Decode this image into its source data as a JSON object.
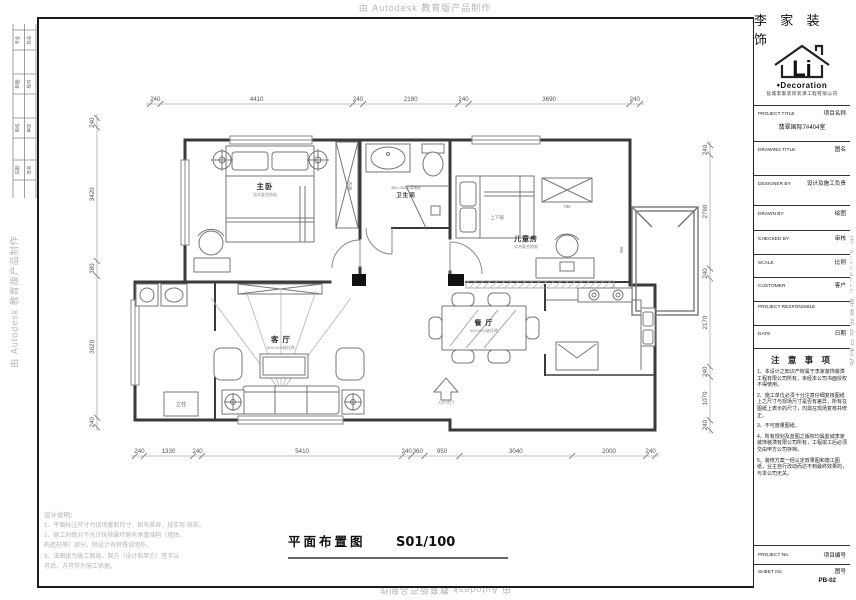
{
  "watermark": "由 Autodesk 教育版产品制作",
  "sheet_title": {
    "label": "平面布置图",
    "scale": "S01/100"
  },
  "design_notes": {
    "title": "设计说明：",
    "lines": [
      "1、平面标注尺寸为现场量取尺寸，如有差异，按实际 核实。",
      "2、施工时绝对不允许拆除破坏原有承重结构（墙体、",
      "构造柱等）部分，除设计有特殊说明外。",
      "3、该图纸为施工图纸，双方（设计和甲方）签字认",
      "可后，方可作为施工依据。"
    ]
  },
  "sign_strip": {
    "rows": [
      [
        "专业",
        "姓名"
      ],
      [
        "制图",
        "校对"
      ],
      [
        "审核",
        "审定"
      ],
      [
        "日期",
        "签名"
      ]
    ]
  },
  "title_block": {
    "brand": "李 家 装 饰",
    "logo_text": "Li",
    "logo_sub": "Decoration",
    "company": "盐城李家装饰装潢工程有限公司",
    "fields": [
      {
        "en": "PROJECT TITLE",
        "cn": "项目名称",
        "value": "翡翠国际7#404室"
      },
      {
        "en": "DRAWING TITLE",
        "cn": "图名",
        "value": ""
      },
      {
        "en": "DESIGNER BY",
        "cn": "设计及施工负责",
        "value": ""
      },
      {
        "en": "DRAWN BY",
        "cn": "绘图",
        "value": ""
      },
      {
        "en": "CHECKED BY",
        "cn": "审核",
        "value": ""
      },
      {
        "en": "SCALE",
        "cn": "比例",
        "value": ""
      },
      {
        "en": "CUSTOMER",
        "cn": "客户",
        "value": ""
      },
      {
        "en": "PROJECT RESPONSIBLE",
        "cn": "",
        "value": ""
      },
      {
        "en": "DATE",
        "cn": "日期",
        "value": ""
      }
    ],
    "notice": {
      "title": "注 意 事 项",
      "items": [
        "1、本设计之知识产权属于李家装饰装潢工程有限公司所有，未经本公司书面授权不得使用。",
        "2、施工单位必须十分注意仔细复核图纸上之尺寸与现场尺寸是否有差异，所有在图纸上表示的尺寸，均需在现场复核并修正。",
        "3、不可度量图纸。",
        "4、所有规划及蓝图之版权均属盐城李家装饰装潢有限公司所有，工程竣工后必须交由甲方公司存档。",
        "5、装修方案一经认定效果图和施工图纸，业主自行改动而达不到最终效果的，与本公司无关。"
      ]
    },
    "project_no": {
      "en": "PROJECT No.",
      "cn": "项目编号"
    },
    "sheet_no": {
      "en": "SHEET No.",
      "cn": "图号",
      "value": "PB-02"
    }
  },
  "plan": {
    "rooms": [
      {
        "name": "主卧",
        "sub": "实木复合地板",
        "x": 265,
        "y": 189,
        "size": 7.5
      },
      {
        "name": "卫生间",
        "sub": "",
        "x": 406,
        "y": 197,
        "size": 5.5
      },
      {
        "name": "儿童房",
        "sub": "实木复合地板",
        "x": 526,
        "y": 241,
        "size": 7
      },
      {
        "name": "客 厅",
        "sub": "800×800玻化砖",
        "x": 281,
        "y": 342,
        "size": 7.5
      },
      {
        "name": "餐 厅",
        "sub": "800×800玻化砖",
        "x": 484,
        "y": 325,
        "size": 7
      }
    ],
    "annotations": [
      {
        "text": "300×300防滑地砖",
        "x": 406,
        "y": 189,
        "size": 3.8
      },
      {
        "text": "上下铺",
        "x": 497,
        "y": 219,
        "size": 4.5
      },
      {
        "text": "衣柜",
        "x": 348,
        "y": 186,
        "size": 4.5,
        "rot": 90
      },
      {
        "text": "立柱",
        "x": 181,
        "y": 406,
        "size": 5.5
      },
      {
        "text": "入户大门",
        "x": 446,
        "y": 404,
        "size": 4.2
      },
      {
        "text": "780",
        "x": 567,
        "y": 208,
        "size": 4.2
      },
      {
        "text": "900",
        "x": 620,
        "y": 250,
        "size": 4.2,
        "rot": 90
      }
    ],
    "dims": {
      "top": {
        "values": [
          240,
          4410,
          240,
          2180,
          240,
          3690,
          240
        ]
      },
      "bottom": {
        "values": [
          240,
          1330,
          240,
          5410,
          240,
          360,
          950,
          3040,
          2000,
          240
        ]
      },
      "left": {
        "values": [
          240,
          3420,
          380,
          3620,
          240
        ]
      },
      "right": {
        "values": [
          240,
          2790,
          240,
          2170,
          240,
          1070,
          240
        ]
      }
    }
  }
}
